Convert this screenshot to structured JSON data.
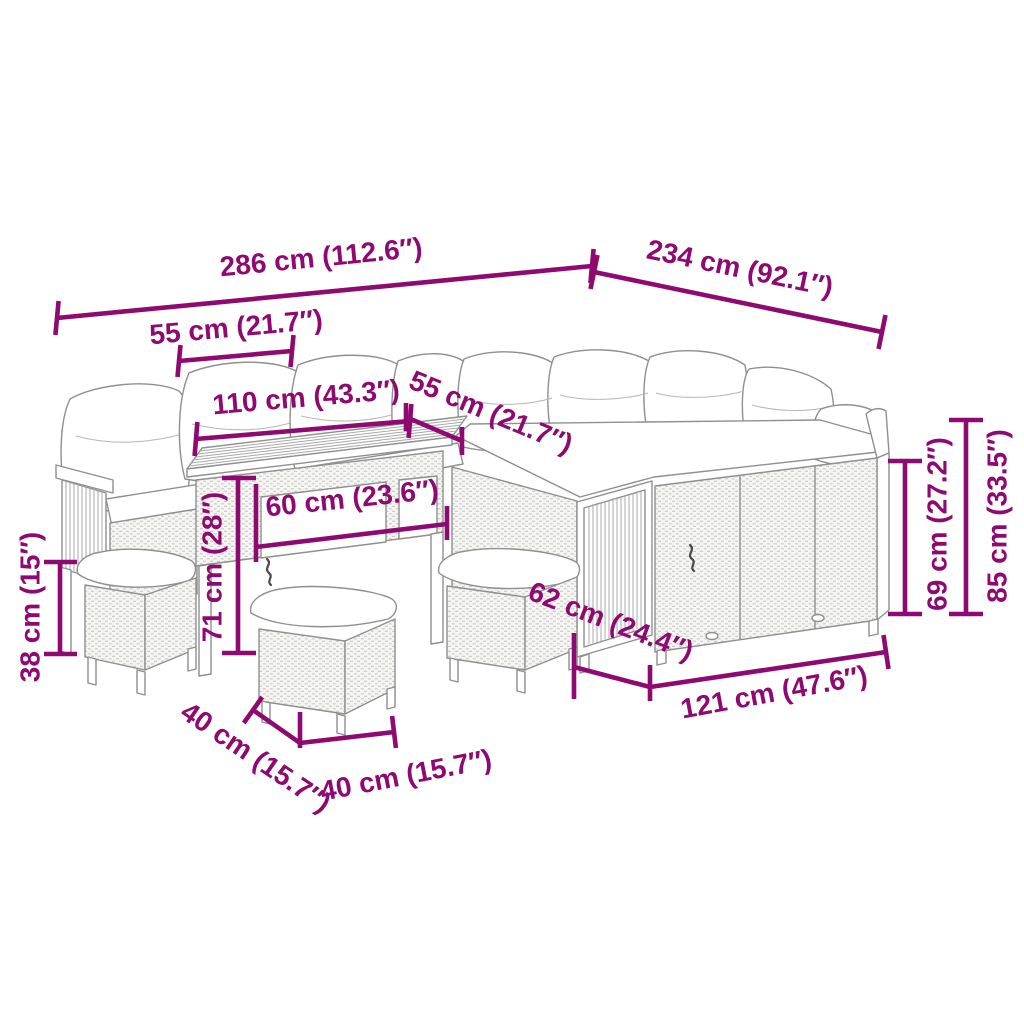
{
  "diagram": {
    "accent_color": "#8E0A70",
    "outline_color": "#8f8f8f",
    "background_color": "#ffffff",
    "dims": {
      "total_width": "286 cm (112.6″)",
      "total_depth": "234 cm (92.1″)",
      "left_seat_width": "55 cm (21.7″)",
      "table_length": "110 cm (43.3″)",
      "corner_seat_width": "55 cm (21.7″)",
      "table_depth": "60 cm (23.6″)",
      "table_height": "71 cm (28″)",
      "stool_height": "38 cm (15″)",
      "stool_depth": "40 cm (15.7″)",
      "stool_width": "40 cm (15.7″)",
      "sofa_depth": "62 cm (24.4″)",
      "right_sofa_width": "121 cm (47.6″)",
      "backrest_height": "69 cm (27.2″)",
      "total_height": "85 cm (33.5″)"
    }
  }
}
